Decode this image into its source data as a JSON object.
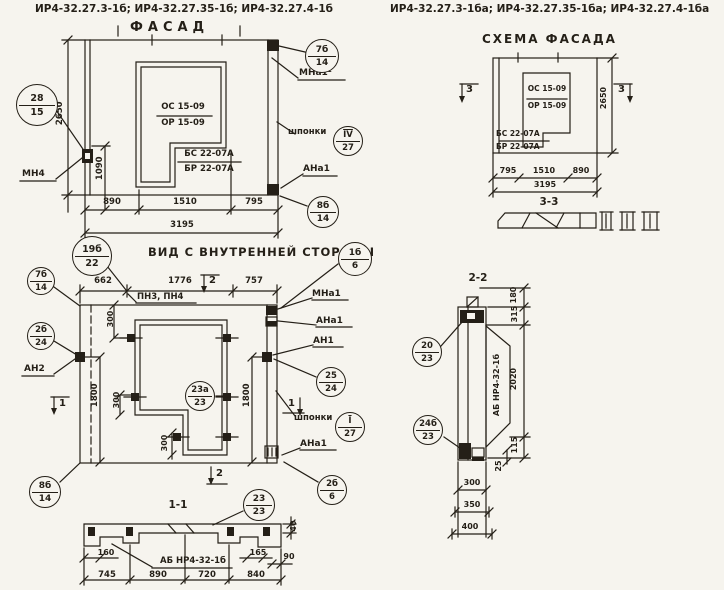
{
  "titles": {
    "left": "ИР4-32.27.3-1б; ИР4-32.27.35-1б; ИР4-32.27.4-1б",
    "right": "ИР4-32.27.3-1ба; ИР4-32.27.35-1ба; ИР4-32.27.4-1ба"
  },
  "facade": {
    "title": "ФАСАД",
    "os": "ОС 15-09",
    "orm": "ОР 15-09",
    "bs": "БС 22-07А",
    "br": "БР 22-07А",
    "mn4": "МН4",
    "mna1": "МНа1¹",
    "shponki": "шпонки",
    "ana1": "АНа1",
    "h": "2650",
    "a": "1090",
    "w1": "890",
    "w2": "1510",
    "w3": "795",
    "total": "3195",
    "b_left_t": "28",
    "b_left_b": "15",
    "b_tr_t": "7б",
    "b_tr_b": "14",
    "b_key_t": "IV",
    "b_key_b": "27",
    "b_br_t": "8б",
    "b_br_b": "14"
  },
  "scheme": {
    "title": "СХЕМА ФАСАДА",
    "os": "ОС 15-09",
    "orm": "ОР 15-09",
    "bs": "БС 22-07А",
    "br": "БР 22-07А",
    "mark_left": "3",
    "mark_right": "3",
    "sec": "3-3",
    "h": "2650",
    "w1": "795",
    "w2": "1510",
    "w3": "890",
    "total": "3195"
  },
  "inner": {
    "title": "ВИД С ВНУТРЕННЕЙ СТОРОНЫ",
    "pn": "ПН3, ПН4",
    "mna1": "МНа1",
    "ana1": "АНа1",
    "an1": "АН1",
    "an2": "АН2",
    "shponki": "шпонки",
    "ana1b": "АНа1",
    "w1": "662",
    "w2": "1776",
    "w3": "757",
    "h1": "1800",
    "h2": "1800",
    "e1": "300",
    "e2": "300",
    "e3": "300",
    "mt": "2",
    "mb": "2",
    "ml": "1",
    "mr": "1",
    "b19t": "19б",
    "b19b": "22",
    "b7t": "7б",
    "b7b": "14",
    "b2b24t": "2б",
    "b2b24b": "24",
    "b1b6t": "1б",
    "b1b6b": "6",
    "b25t": "25",
    "b25b": "24",
    "bIt": "I",
    "bIb": "27",
    "b2b6t": "2б",
    "b2b6b": "6",
    "b23at": "23а",
    "b23ab": "23",
    "b8bt": "8б",
    "b8bb": "14"
  },
  "s11": {
    "title": "1-1",
    "label": "АБ НР4-32-1б",
    "d40": "40",
    "d160": "160",
    "d165": "165",
    "d90": "90",
    "w1": "745",
    "w2": "890",
    "w3": "720",
    "w4": "840",
    "bt": "23",
    "bb": "23"
  },
  "s22": {
    "title": "2-2",
    "label": "АБ НР4-32-1б",
    "d180": "180",
    "d315": "315",
    "d2020": "2020",
    "d115": "115",
    "d25": "25",
    "w300": "300",
    "w350": "350",
    "w400": "400",
    "but": "20",
    "bub": "23",
    "blt": "24б",
    "blb": "23"
  }
}
